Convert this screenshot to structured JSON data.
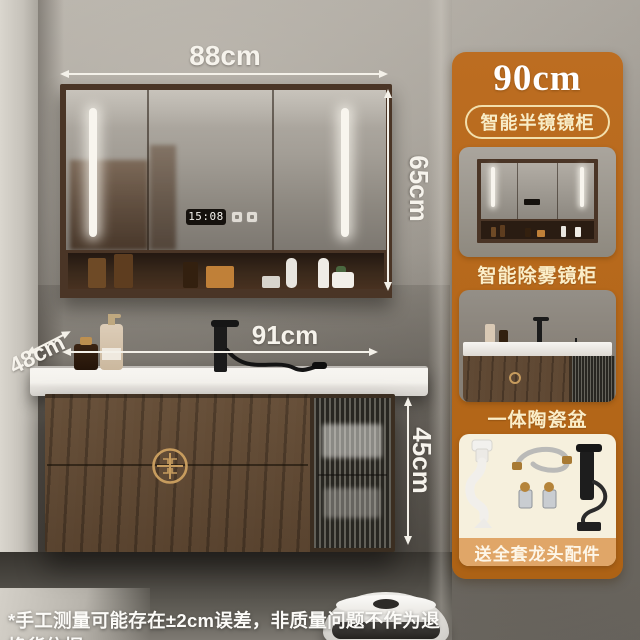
{
  "scene": {
    "clock_time": "15:08",
    "disclaimer": "*手工测量可能存在±2cm误差，非质量问题不作为退换货依据"
  },
  "dimensions": {
    "mirror_width": "88cm",
    "mirror_height": "65cm",
    "vanity_width": "91cm",
    "vanity_depth": "48cm",
    "vanity_height": "45cm"
  },
  "panel": {
    "title": "90cm",
    "badge": "智能半镜镜柜",
    "captions": [
      "智能除雾镜柜",
      "一体陶瓷盆",
      "送全套龙头配件"
    ]
  },
  "colors": {
    "panel_bg": "#b8691f",
    "badge_text": "#f8ecc6",
    "caption_text": "#fbeec8",
    "card3_bg": "#f6f0dd",
    "caption3_strip_bg": "#e0a668",
    "wood": "#55412f",
    "gold_accent": "#c79c5e",
    "dimension_text": "#f6f3ec",
    "led_white": "#f8f5ee"
  }
}
